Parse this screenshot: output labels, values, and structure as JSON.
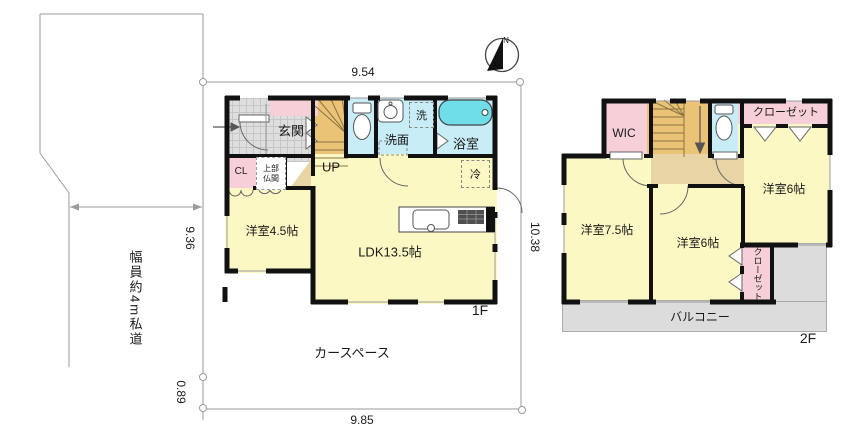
{
  "colors": {
    "room_yellow": "#FCF8C3",
    "room_pink": "#F7CFD8",
    "room_blue": "#C9EDF6",
    "bathtub_cyan": "#6FDEE8",
    "stairs_orange": "#EAC377",
    "hall_tan": "#E8D4A4",
    "balcony_gray": "#DCDCDC",
    "wall_black": "#111111",
    "site_line_gray": "#9a9a9a"
  },
  "compass": {
    "north_label": "N"
  },
  "site": {
    "road_label": "幅員約4m私道",
    "car_space_label": "カースペース",
    "dim_top": "9.54",
    "dim_left": "9.36",
    "dim_left_lower": "0.89",
    "dim_bottom": "9.85",
    "dim_right": "10.38"
  },
  "floor1": {
    "label": "1F",
    "genkan": "玄関",
    "stairs_up": "UP",
    "washer": "洗",
    "washroom": "洗面",
    "bathroom": "浴室",
    "closet": "CL",
    "butsuma": "上部仏間",
    "bedroom": "洋室4.5帖",
    "ldk": "LDK13.5帖",
    "fridge": "冷"
  },
  "floor2": {
    "label": "2F",
    "wic": "WIC",
    "closet_top": "クローゼット",
    "bedroom_right": "洋室6帖",
    "bedroom_left": "洋室7.5帖",
    "bedroom_mid": "洋室6帖",
    "closet_side": "クローゼット",
    "balcony": "バルコニー"
  }
}
